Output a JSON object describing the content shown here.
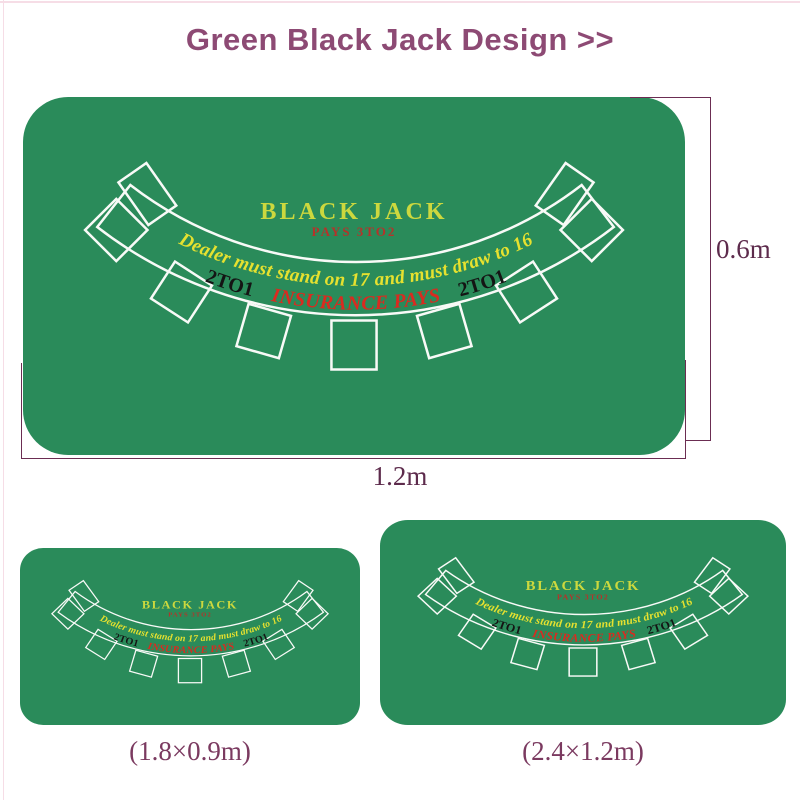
{
  "page": {
    "title": "Green Black Jack Design >>"
  },
  "colors": {
    "felt_green": "#2a8b5a",
    "layout_line_white": "#f8faf7",
    "blackjack_yellow": "#ccd83e",
    "rule_text_yellow": "#e6e12f",
    "insurance_red": "#d92b20",
    "payout_red": "#b5332a",
    "odds_black": "#141414",
    "title_purple": "#8d4a74",
    "dimension_line": "#6b2d52",
    "dimension_label": "#5d2b4c",
    "size_label": "#7b3a60"
  },
  "table_design": {
    "name": "BLACK JACK",
    "payout": "PAYS 3TO2",
    "dealer_rule": "Dealer must stand on 17 and must draw to 16",
    "insurance": {
      "left": "2TO1",
      "center": "INSURANCE PAYS",
      "right": "2TO1"
    },
    "player_spots_count": 7
  },
  "dimensions": {
    "height": "0.6m",
    "width": "1.2m"
  },
  "variants": [
    {
      "size": "(1.8×0.9m)"
    },
    {
      "size": "(2.4×1.2m)"
    }
  ]
}
